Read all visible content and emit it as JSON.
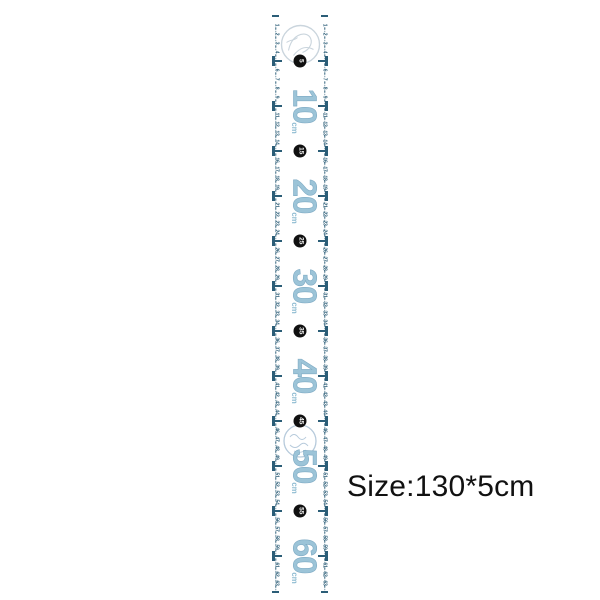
{
  "product_label": {
    "size_text": "Size:130*5cm"
  },
  "ruler": {
    "unit_label": "cm",
    "start_cm": 0,
    "end_cm": 64,
    "px_per_cm": 9.0,
    "edge_number_start": 1,
    "edge_number_end": 63,
    "big_number_positions": [
      10,
      20,
      30,
      40,
      50,
      60
    ],
    "circle_marker_positions": [
      5,
      15,
      25,
      35,
      45,
      55
    ],
    "colors": {
      "tick_and_small_text": "#2b5d77",
      "big_number": "#9cc4d8",
      "unit_text": "#8fbcd2",
      "circle_background": "#101010",
      "circle_text": "#ffffff",
      "stamp_top": "#b9c7d2",
      "stamp_middle": "#a4bdd3",
      "size_text": "#111111",
      "background": "#ffffff"
    }
  }
}
